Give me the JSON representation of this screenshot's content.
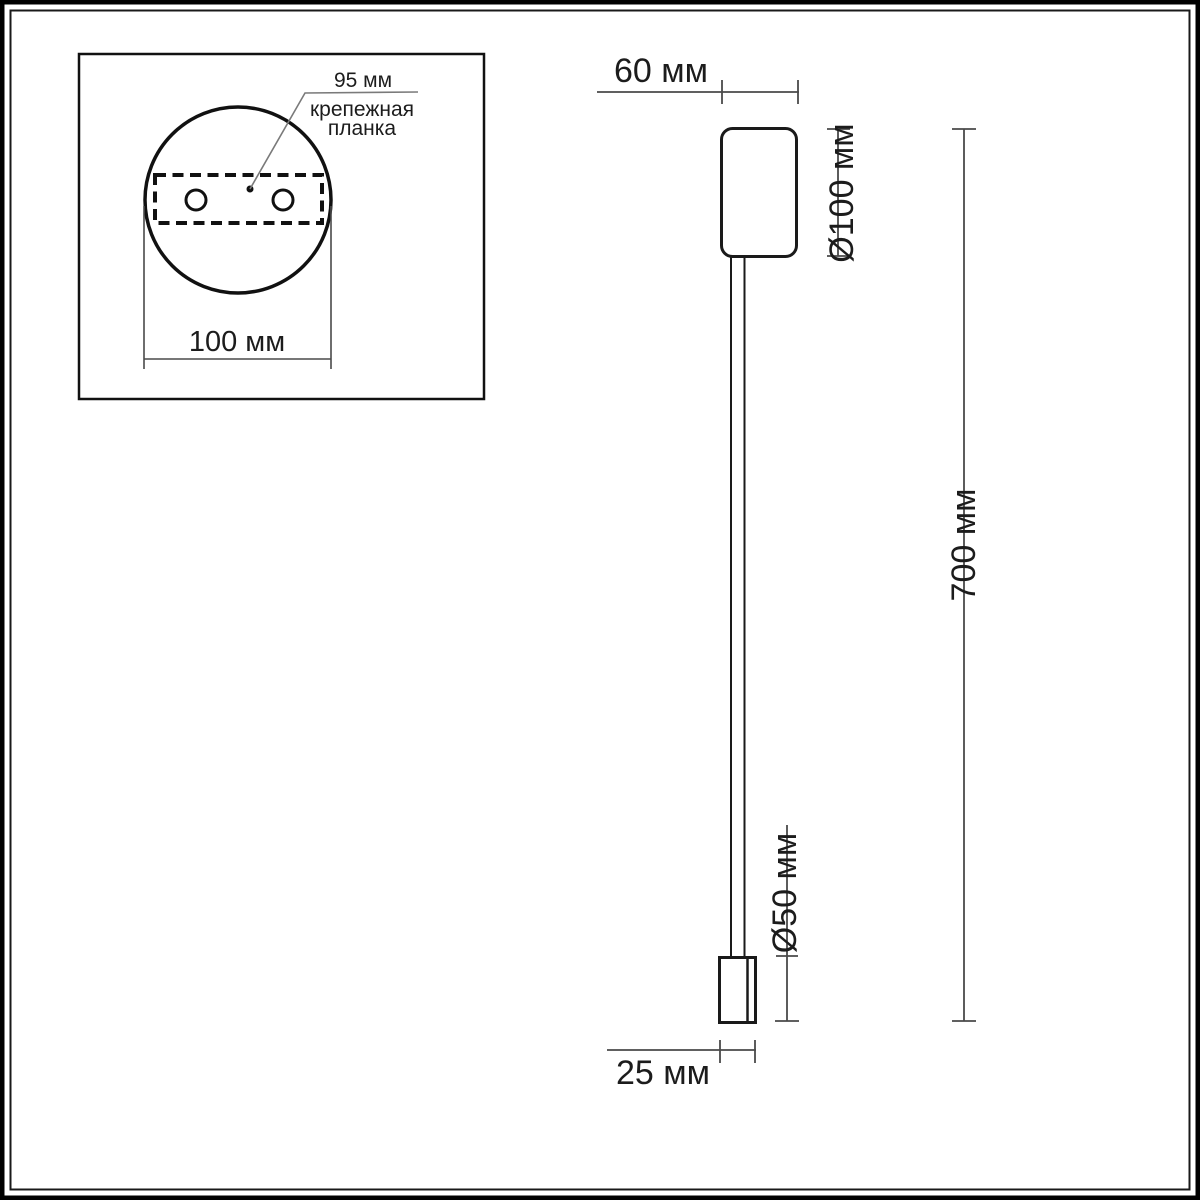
{
  "colors": {
    "object_line": "#1a1a1a",
    "dim_line": "#4a4a4a",
    "leader_line": "#7a7a7a",
    "background": "#ffffff"
  },
  "detail_view": {
    "plate_span_label": "95 мм",
    "plate_name_line1": "крепежная",
    "plate_name_line2": "планка",
    "base_diameter_label": "100 мм"
  },
  "side_view": {
    "base_width_label": "60 мм",
    "base_diameter_label": "Ø100 мм",
    "total_height_label": "700 мм",
    "head_height_label": "Ø50 мм",
    "head_width_label": "25 мм"
  }
}
